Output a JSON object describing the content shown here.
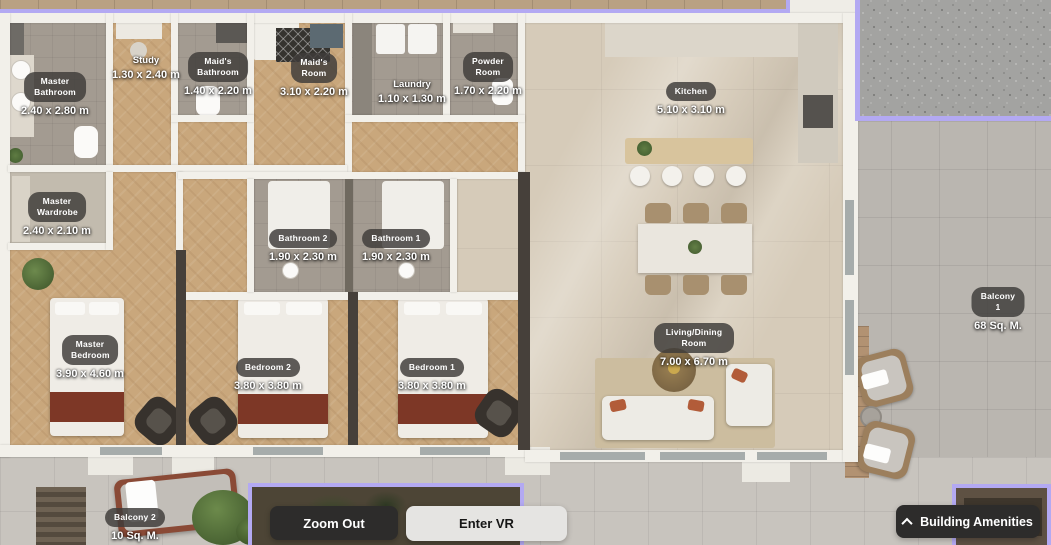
{
  "rooms": [
    {
      "name": "Master Bathroom",
      "dims": "2.40 x 2.80 m"
    },
    {
      "name": "Study",
      "dims": "1.30 x 2.40 m"
    },
    {
      "name": "Maid's Bathroom",
      "dims": "1.40 x 2.20 m"
    },
    {
      "name": "Maid's Room",
      "dims": "3.10 x 2.20 m"
    },
    {
      "name": "Laundry",
      "dims": "1.10 x 1.30 m"
    },
    {
      "name": "Powder Room",
      "dims": "1.70 x 2.20 m"
    },
    {
      "name": "Kitchen",
      "dims": "5.10 x 3.10 m"
    },
    {
      "name": "Master Wardrobe",
      "dims": "2.40 x 2.10 m"
    },
    {
      "name": "Bathroom 2",
      "dims": "1.90 x 2.30 m"
    },
    {
      "name": "Bathroom 1",
      "dims": "1.90 x 2.30 m"
    },
    {
      "name": "Balcony 1",
      "dims": "68 Sq. M."
    },
    {
      "name": "Master Bedroom",
      "dims": "3.90 x 4.60 m"
    },
    {
      "name": "Bedroom 2",
      "dims": "3.80 x 3.80 m"
    },
    {
      "name": "Bedroom 1",
      "dims": "3.80 x 3.80 m"
    },
    {
      "name": "Living/Dining Room",
      "dims": "7.00 x 6.70 m"
    },
    {
      "name": "Balcony 2",
      "dims": "10 Sq. M."
    }
  ],
  "controls": {
    "zoom_out_label": "Zoom Out",
    "enter_vr_label": "Enter VR",
    "building_amenities_label": "Building Amenities",
    "building_amenities_icon": "chevron-up"
  },
  "colors": {
    "unit_highlight": "#b3a9f2",
    "button_dark": "#2d2c2b",
    "button_light": "#e5e4e2",
    "label_pill": "#3e3c3a"
  }
}
